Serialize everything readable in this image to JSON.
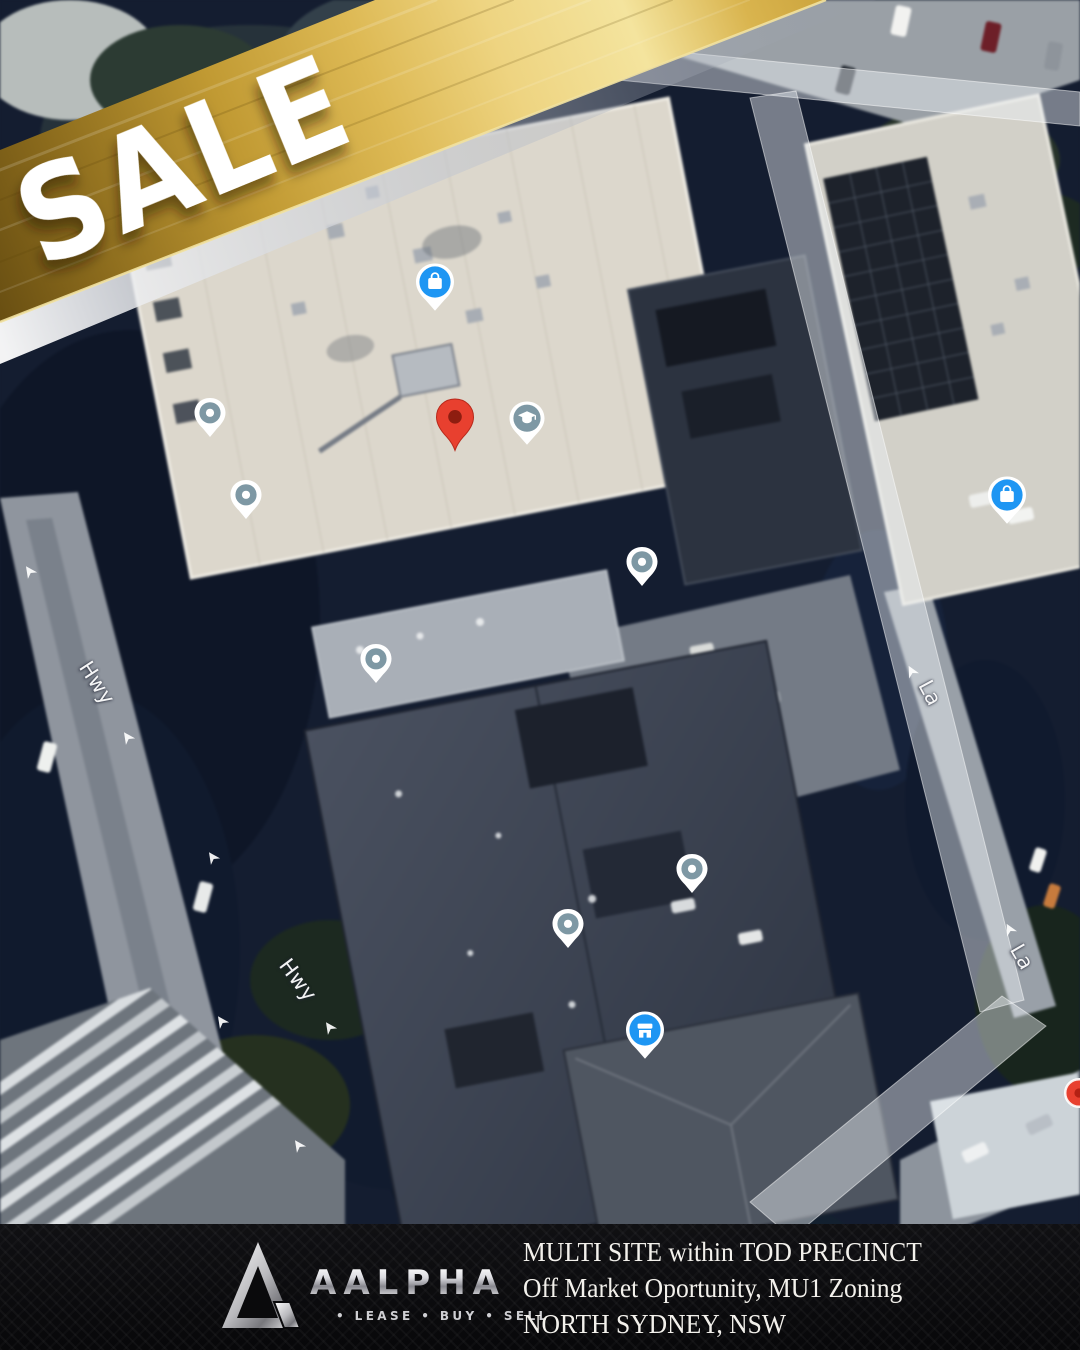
{
  "banner": {
    "label": "SALE"
  },
  "footer": {
    "brand": "AALPHA",
    "tagline": "• LEASE • BUY • SELL",
    "lines": [
      "MULTI SITE within TOD PRECINCT",
      "Off Market Oportunity, MU1 Zoning",
      "NORTH SYDNEY, NSW"
    ]
  },
  "map": {
    "road_labels": [
      {
        "text": "Hwy",
        "x": 97,
        "y": 683,
        "rot": 57
      },
      {
        "text": "Hwy",
        "x": 298,
        "y": 980,
        "rot": 53
      },
      {
        "text": "La",
        "x": 930,
        "y": 693,
        "rot": 62
      },
      {
        "text": "La",
        "x": 1022,
        "y": 957,
        "rot": 60
      }
    ],
    "arrows": [
      {
        "x": 30,
        "y": 572,
        "rot": -35
      },
      {
        "x": 128,
        "y": 738,
        "rot": -35
      },
      {
        "x": 213,
        "y": 858,
        "rot": -35
      },
      {
        "x": 222,
        "y": 1022,
        "rot": -35
      },
      {
        "x": 330,
        "y": 1028,
        "rot": -35
      },
      {
        "x": 299,
        "y": 1146,
        "rot": -35
      },
      {
        "x": 912,
        "y": 672,
        "rot": -28
      },
      {
        "x": 1010,
        "y": 930,
        "rot": -28
      }
    ],
    "pins": [
      {
        "type": "shopping-bag",
        "x": 435,
        "y": 282
      },
      {
        "type": "shopping-bag",
        "x": 1007,
        "y": 495
      },
      {
        "type": "storefront",
        "x": 645,
        "y": 1030
      },
      {
        "type": "school",
        "x": 527,
        "y": 418
      },
      {
        "type": "property-marker",
        "x": 455,
        "y": 452
      },
      {
        "type": "poi-dot",
        "x": 210,
        "y": 413
      },
      {
        "type": "poi-dot",
        "x": 246,
        "y": 495
      },
      {
        "type": "poi-dot",
        "x": 642,
        "y": 562
      },
      {
        "type": "poi-dot",
        "x": 376,
        "y": 659
      },
      {
        "type": "poi-dot",
        "x": 692,
        "y": 869
      },
      {
        "type": "poi-dot",
        "x": 568,
        "y": 924
      },
      {
        "type": "poi-red-partial",
        "x": 1079,
        "y": 1093
      }
    ]
  },
  "colors": {
    "gold": "#c9a43c",
    "banner_text": "#ffffff",
    "pin_blue": "#1e96f3",
    "pin_slate": "#7e98a4",
    "pin_red": "#e8402f",
    "pin_red_dark": "#8e1d10",
    "footer_bg": "#0a0a0c",
    "footer_text": "#f3f1ec"
  }
}
